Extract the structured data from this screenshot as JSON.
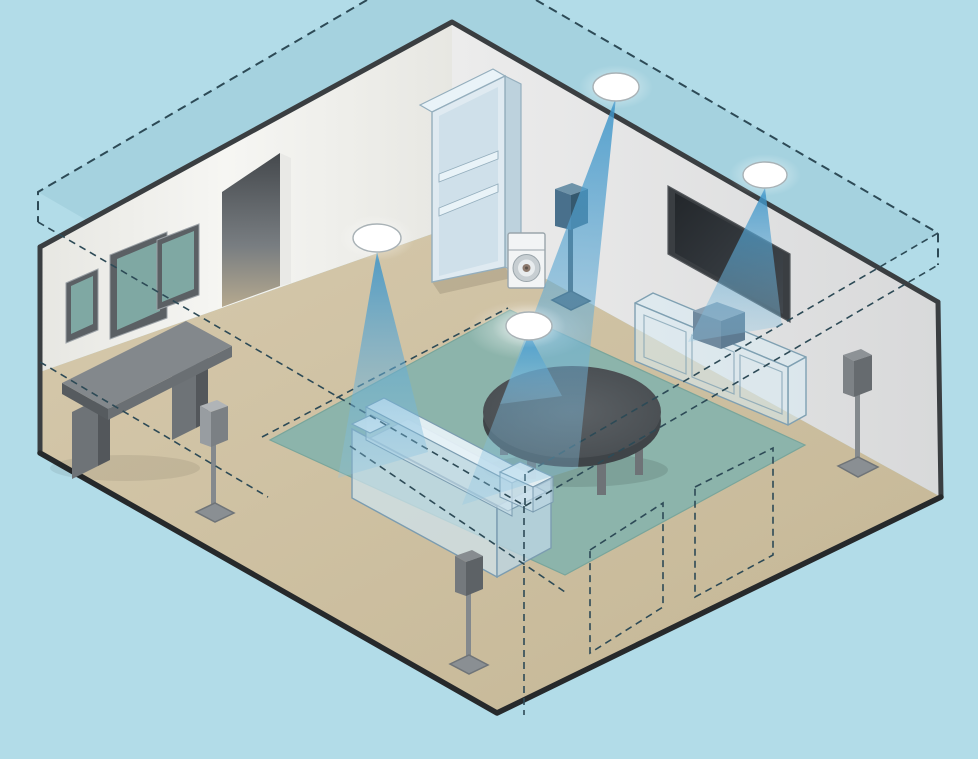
{
  "page_title": "In-ceiling speaker placement room diagram",
  "scene": {
    "type": "isometric-room-cutaway-illustration",
    "description": "Cutaway isometric living room showing four white in-ceiling speakers on a translucent dashed ceiling plane, each projecting a blue sound cone into the room; four floor-stand speakers, a center speaker on a ghosted media console under a wall-mounted TV, a ghosted sofa, oval coffee table on a teal rug, bookshelf, disc media player, desk, three framed pictures and a doorway; dashed construction lines and two dashed floor placement zones.",
    "counts": {
      "ceiling_speakers": 4,
      "sound_cones": 4,
      "floor_stand_speakers": 4,
      "wall_pictures": 3,
      "placement_zones": 2
    },
    "objects": [
      "ceiling-plane",
      "ceiling-speaker",
      "sound-cone",
      "left-wall",
      "right-wall",
      "doorway",
      "picture-frame",
      "desk",
      "bookshelf",
      "media-player",
      "floor",
      "rug",
      "coffee-table",
      "sofa",
      "tv",
      "media-console",
      "center-speaker",
      "stand-speaker",
      "placement-zone",
      "construction-lines",
      "room-outline"
    ]
  },
  "colors": {
    "bg": "#b2dce8",
    "planeFill": "#7fb2c4",
    "dash": "#2d4a56",
    "wallLeft1": "#f6f6f3",
    "wallLeft2": "#e7e7e2",
    "wallRight1": "#ececec",
    "wallRight2": "#d8d9da",
    "wallEdge": "#3a3e41",
    "floor1": "#d6c9ac",
    "floor2": "#c4b695",
    "floorEdge": "#26292b",
    "rug": "#8cb4ab",
    "rugEdge": "#79a59b",
    "coneTop": "#3a93c8",
    "coneBot": "#8ec6e3",
    "ovalFill": "#ffffff",
    "ovalRing": "#a9b2b6",
    "ghostFill": "#d9ecf5",
    "ghostStroke": "#7fa0b2",
    "sofaLight": "#eaf4f9",
    "sofaMid": "#cfe3ee",
    "sofaDark": "#bcd6e4",
    "deskTop": "#83888c",
    "deskSide": "#565b5f",
    "legGray": "#6e7377",
    "tvFrame": "#3a3e42",
    "tvScreen1": "#23272b",
    "tvScreen2": "#41474d",
    "tableTop": "#545a5e",
    "tableRim": "#3f4448",
    "spkFrontA": "#989da1",
    "spkSideA": "#7b8084",
    "spkTopA": "#b0b4b7",
    "spkFrontB": "#74797d",
    "spkSideB": "#5d6266",
    "spkTopB": "#878c90",
    "spkFrontC": "#7d8286",
    "spkSideC": "#666b6f",
    "spkTopC": "#8d9296",
    "spkFrontE": "#49708c",
    "spkSideE": "#35596f",
    "spkTopE": "#6e93a9",
    "pole": "#84898d",
    "poleDark": "#3f4b55",
    "baseTop": "#8a8f93",
    "baseSide": "#6f7478",
    "centerTop": "#8ba3b6",
    "centerFront": "#6f899e",
    "centerSide": "#5e7b92",
    "doorTop": "#45494d",
    "doorMid": "#787d81",
    "doorBot": "#b5a98f",
    "jamb": "#e9e9e6",
    "frame": "#5b6064",
    "frameHi": "#9aa0a5",
    "glass": "#7fa8a3",
    "shelfFill": "#dfeaf1",
    "shelfInner": "#cfe0ea",
    "shelfSide": "#bdd2dd",
    "shelfLine": "#94aebd",
    "shelfBand": "#e9f3f8",
    "playerBody": "#f2f4f5",
    "playerStroke": "#9aa5ab",
    "discRing": "#c7ced2",
    "discHub": "#8d7a6e"
  }
}
